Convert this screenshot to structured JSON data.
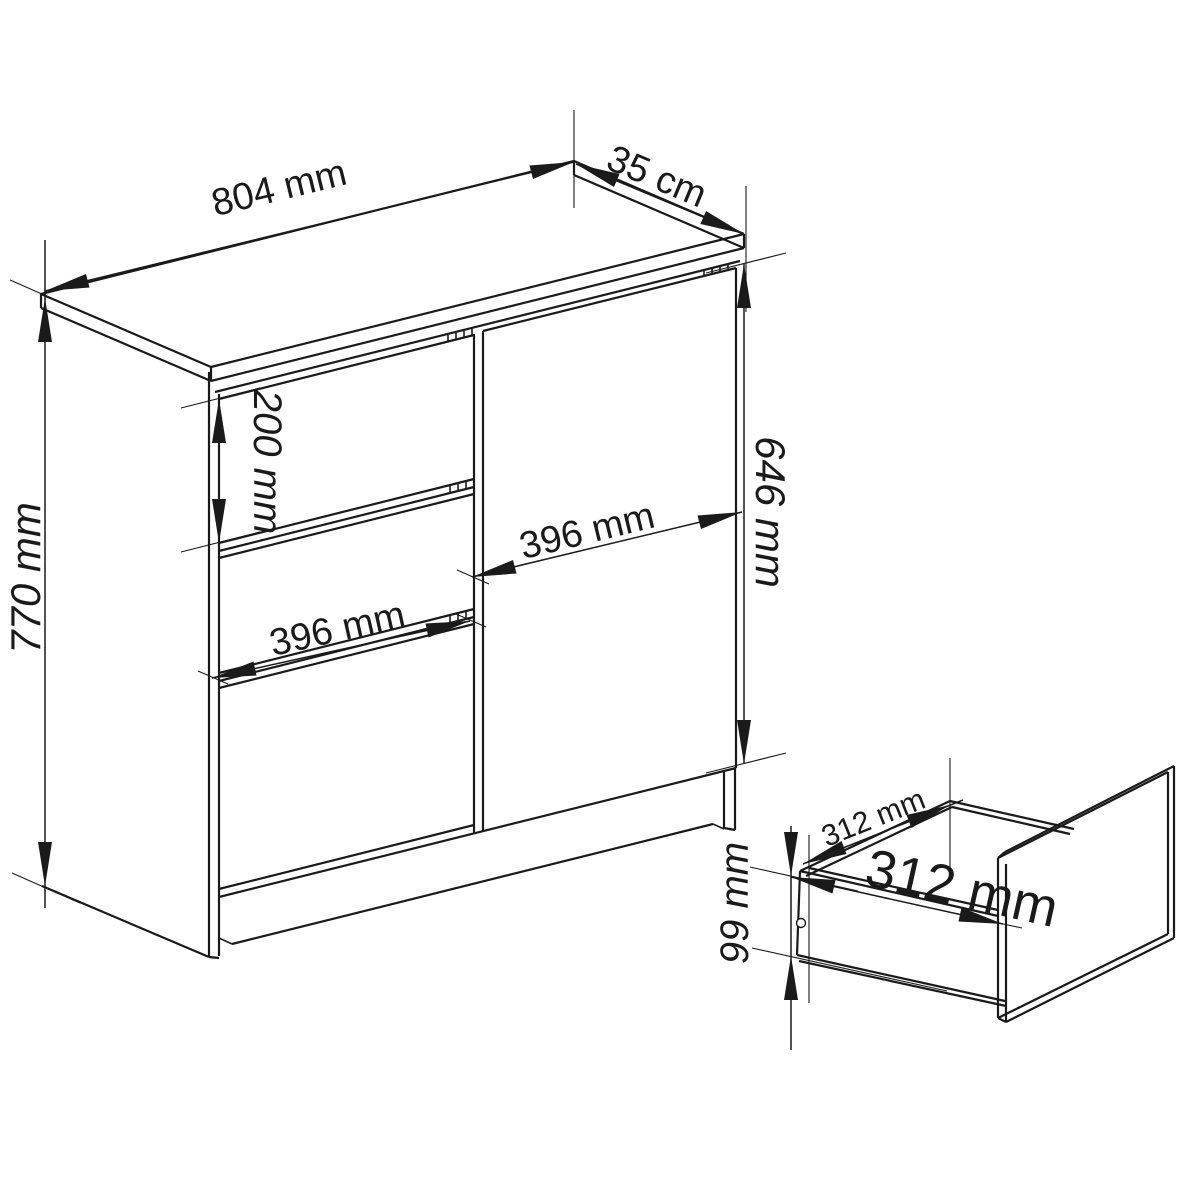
{
  "drawing": {
    "type": "furniture-dimension-diagram",
    "subject": "chest of drawers with door and pull-out drawer detail",
    "colors": {
      "line": "#1a1a1a",
      "background": "#ffffff"
    },
    "dimensions": {
      "overall_width": "804 mm",
      "overall_depth": "35 cm",
      "overall_height": "770 mm",
      "top_drawer_height": "200 mm",
      "drawer_front_width": "396 mm",
      "door_width": "396 mm",
      "door_height": "646 mm",
      "drawer_inner_depth": "312 mm",
      "drawer_inner_width": "312 mm",
      "drawer_inner_height": "99 mm"
    }
  }
}
